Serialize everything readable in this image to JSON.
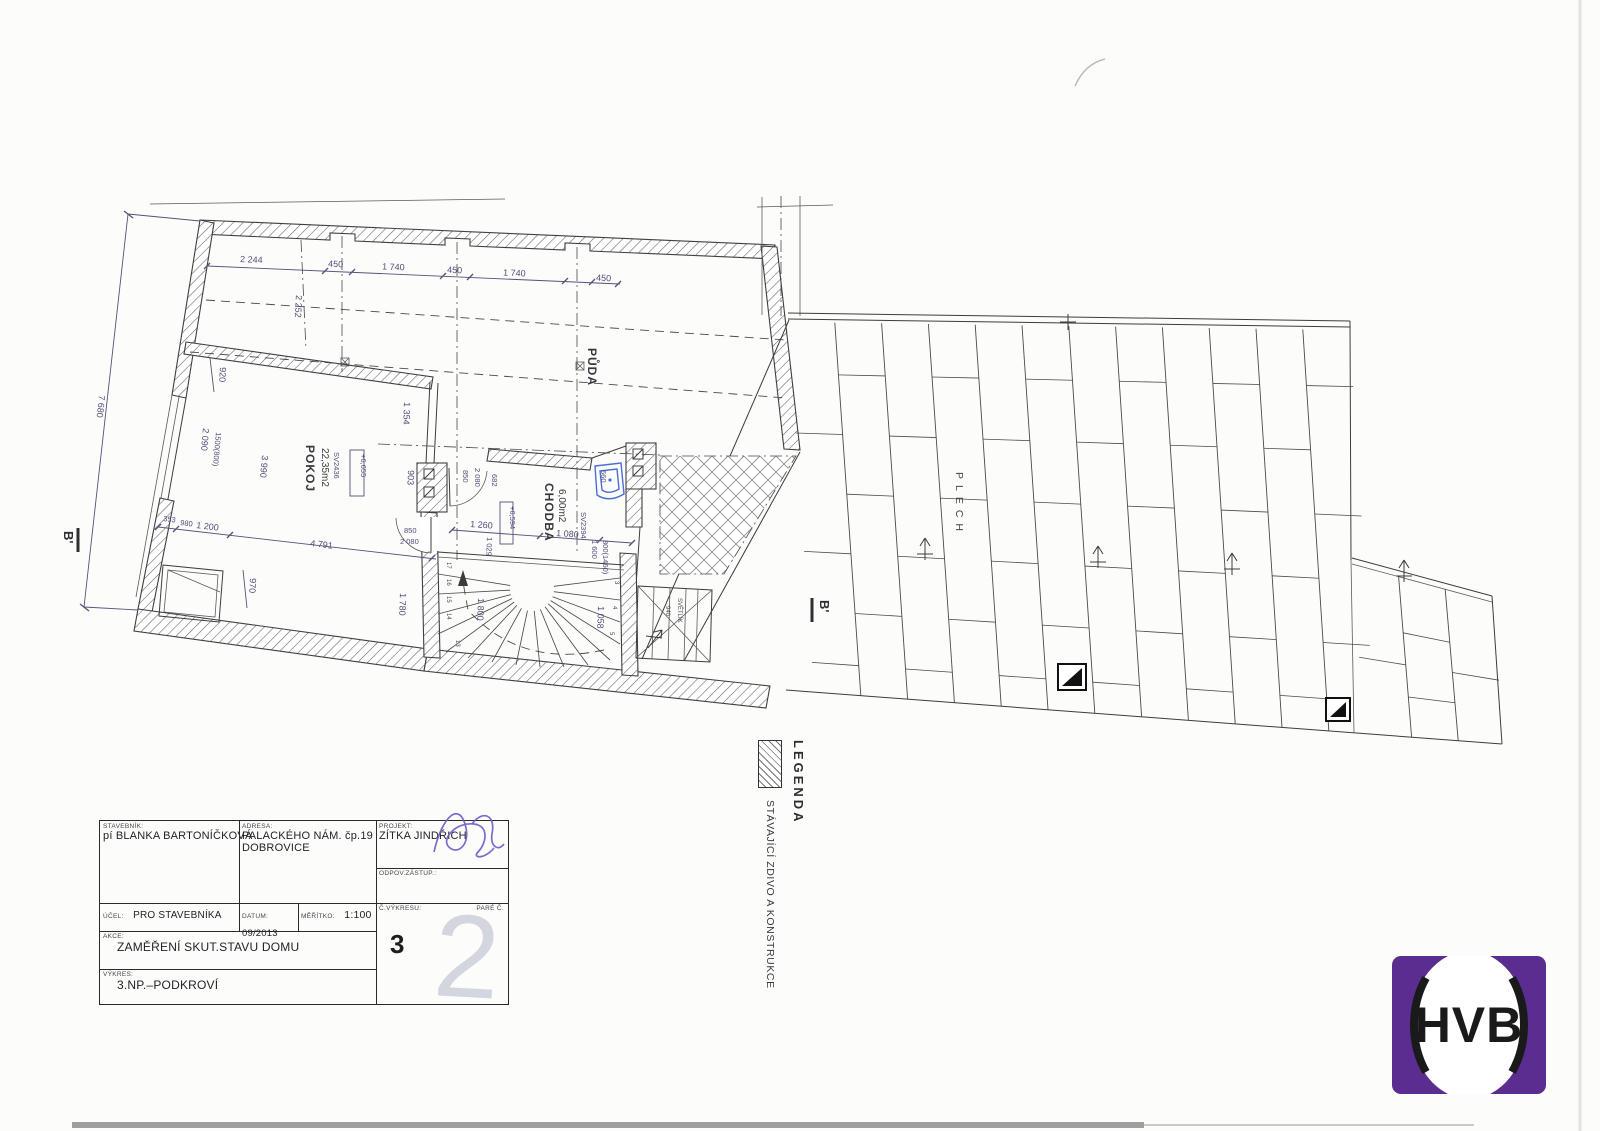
{
  "plan": {
    "rooms": {
      "puda": "PŮDA",
      "pokoj": "POKOJ",
      "pokoj_area": "22,35m2",
      "chodba": "CHODBA",
      "chodba_area": "6,00m2"
    },
    "roof": {
      "plech": "PLECH"
    },
    "markers": {
      "b_left": "B'",
      "b_roof": "B'"
    },
    "levels": {
      "l1": "+6,655",
      "l2": "+6,594"
    },
    "windows": {
      "w1": "SV2436",
      "w2": "SV2394"
    },
    "skylight": {
      "label": "SVĚTLÍK",
      "size": "940"
    },
    "dims": {
      "d2244": "2 244",
      "d450": "450",
      "d1740": "1 740",
      "d2252": "2 252",
      "d7680": "7 680",
      "d920": "920",
      "d2090": "2 090",
      "d1500": "1500(800)",
      "d3990": "3 990",
      "d1354": "1 354",
      "d903": "903",
      "d850": "850",
      "d2080": "2 080",
      "d682": "682",
      "d980": "980",
      "d1200": "1 200",
      "d4791": "4 791",
      "d353": "353",
      "d970": "970",
      "d1780": "1 780",
      "d1800": "1 800",
      "d1058": "1 058",
      "d1260": "1 260",
      "d1029": "1 029",
      "d1080": "1 080",
      "d1600": "1 600",
      "d800": "800(1460)",
      "d660": "660"
    },
    "stair_numbers": {
      "n17": "17",
      "n16": "16",
      "n15": "15",
      "n14": "14",
      "n13": "13",
      "n5": "5",
      "n4": "4",
      "n3": "3"
    }
  },
  "legend": {
    "title": "LEGENDA",
    "item1": "STÁVAJÍCÍ ZDIVO A KONSTRUKCE"
  },
  "titleblock": {
    "stavebnik_label": "STAVEBNÍK:",
    "stavebnik": "pí BLANKA BARTONÍČKOVÁ",
    "adresa_label": "ADRESA:",
    "adresa1": "PALACKÉHO NÁM. čp.19",
    "adresa2": "DOBROVICE",
    "projekt_label": "PROJEKT:",
    "projekt": "ZÍTKA JINDŘICH",
    "odpov_label": "ODPOV.ZÁSTUP.:",
    "ucel_label": "ÚČEL:",
    "ucel": "PRO STAVEBNÍKA",
    "datum_label": "DATUM:",
    "datum": "09/2013",
    "meritko_label": "MĚŘÍTKO:",
    "meritko": "1:100",
    "cvykresu_label": "Č.VÝKRESU:",
    "cislo": "3",
    "pare_label": "PARÉ Č.",
    "pare_stamp": "2",
    "akce_label": "AKCE:",
    "akce": "ZAMĚŘENÍ SKUT.STAVU DOMU",
    "vykres_label": "VÝKRES:",
    "vykres": "3.NP.–PODKROVÍ"
  },
  "logo": {
    "text": "HVB",
    "color": "#5c2d91"
  }
}
